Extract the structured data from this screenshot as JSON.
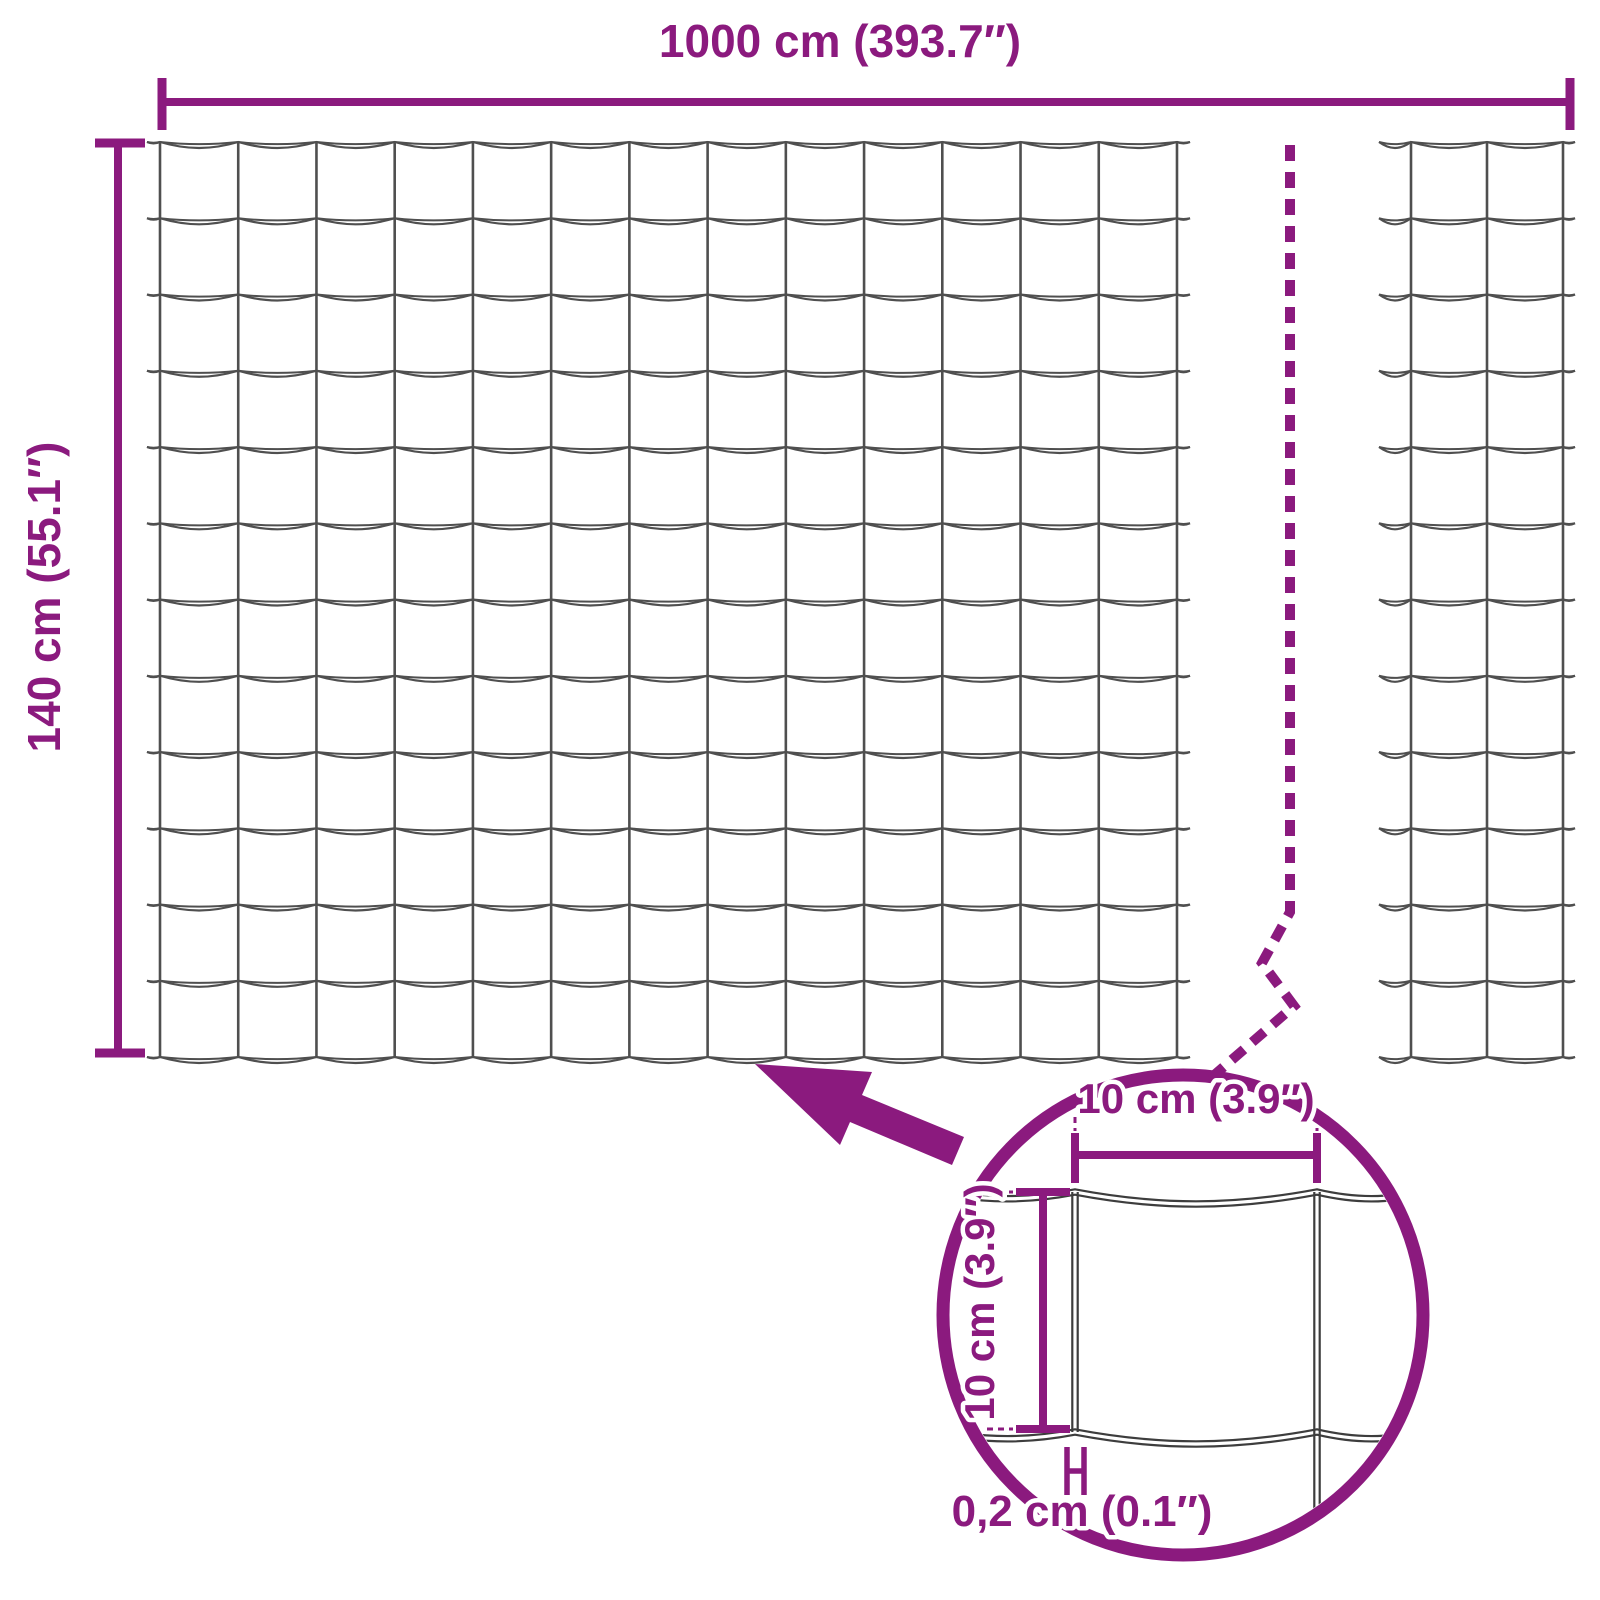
{
  "title": "Welded wire mesh fence dimension diagram",
  "colors": {
    "accent": "#8b1a7e",
    "wire": "#4f4f4f",
    "detail_wire": "#3d3d3d",
    "background": "#ffffff"
  },
  "labels": {
    "total_width": "1000 cm (393.7″)",
    "total_height": "140 cm (55.1″)",
    "mesh_opening_width": "10 cm (3.9″)",
    "mesh_opening_height": "10 cm (3.9″)",
    "wire_thickness": "0,2 cm (0.1″)"
  },
  "diagram": {
    "main_mesh": {
      "columns": 13,
      "rows": 12
    },
    "side_mesh": {
      "columns": 2,
      "rows": 12
    },
    "magnifier_mesh": {
      "columns": 1,
      "rows": 1
    }
  }
}
